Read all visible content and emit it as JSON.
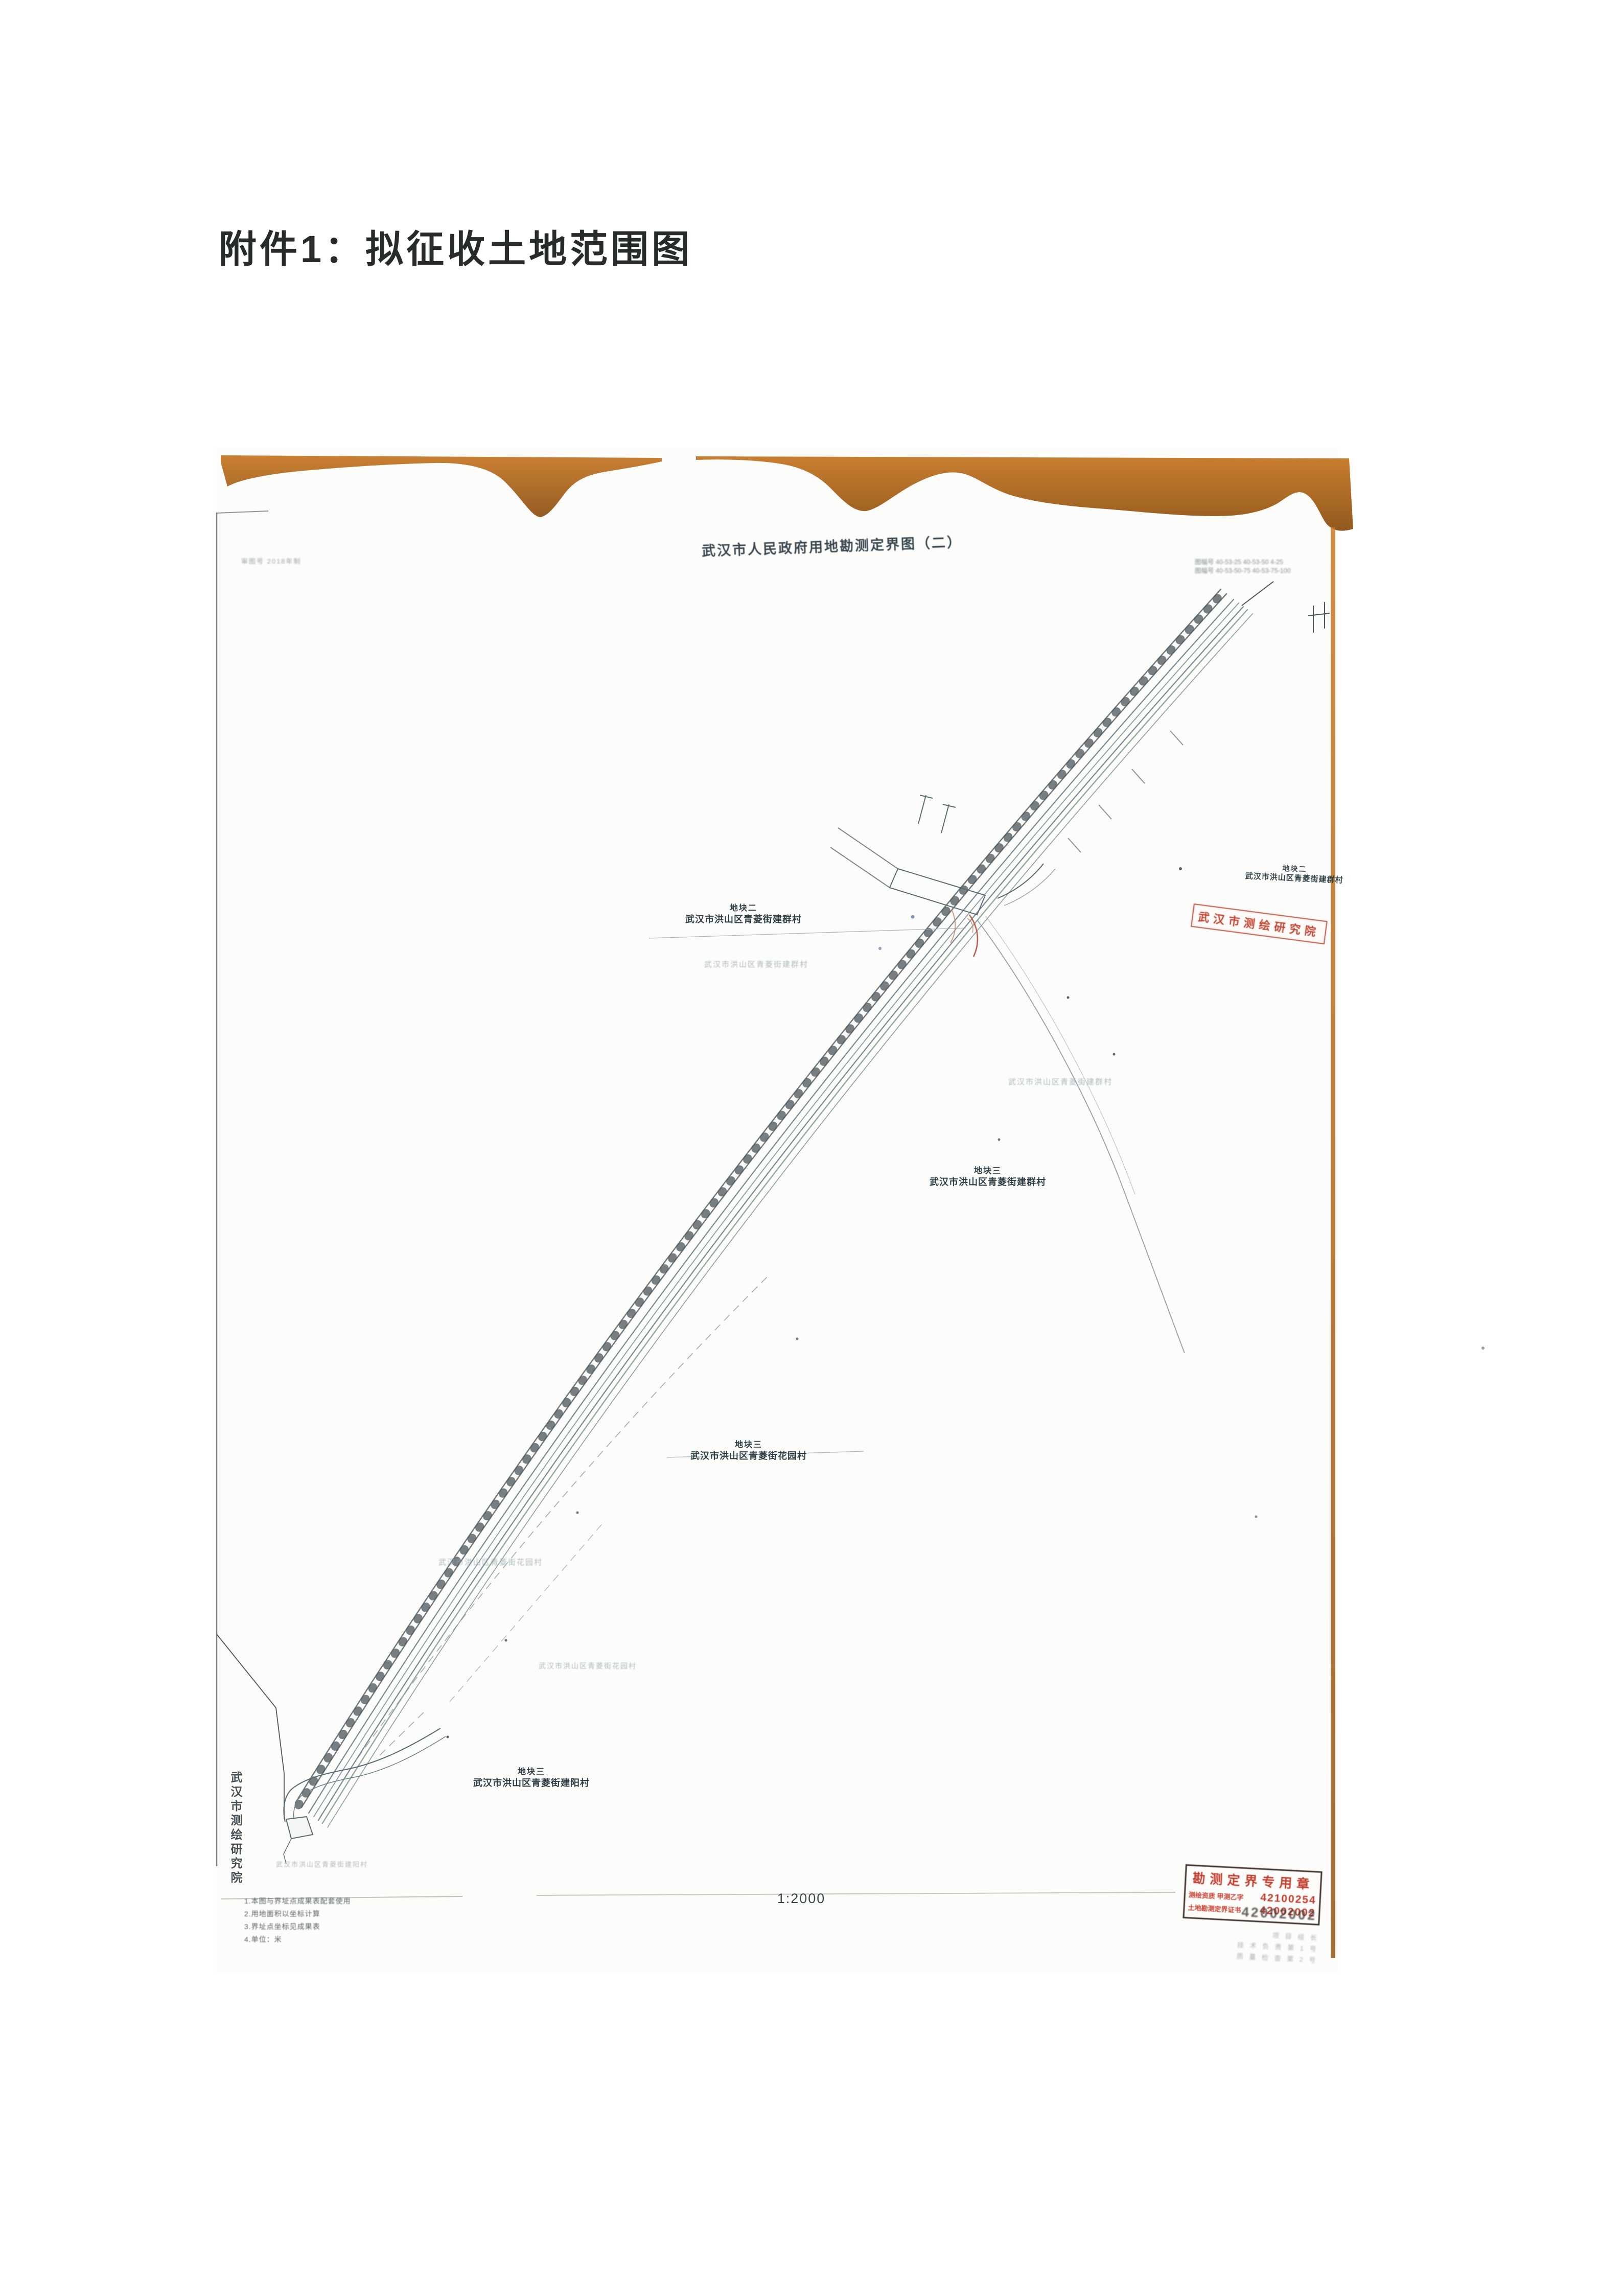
{
  "attachment": {
    "title": "附件1：拟征收土地范围图"
  },
  "map": {
    "title": "武汉市人民政府用地勘测定界图（二）",
    "scale_label": "1:2000",
    "top_left_note": "审图号 2018年制",
    "sheet_numbers": {
      "line1": "图幅号 40-53-25 40-53-50 4-25",
      "line2": "图幅号 40-53-50-75 40-53-75-100"
    },
    "plot_labels": [
      {
        "line1": "地块二",
        "line2": "武汉市洪山区青菱街建群村"
      },
      {
        "line1": "地块二",
        "line2": "武汉市洪山区青菱街建群村"
      },
      {
        "line1": "地块三",
        "line2": "武汉市洪山区青菱街建群村"
      },
      {
        "line1": "地块三",
        "line2": "武汉市洪山区青菱街花园村"
      },
      {
        "line1": "地块三",
        "line2": "武汉市洪山区青菱街建阳村"
      }
    ],
    "faint_labels": [
      "武汉市洪山区青菱街建群村",
      "武汉市洪山区青菱街建群村",
      "武汉市洪山区青菱街花园村",
      "武汉市洪山区青菱街花园村",
      "武汉市洪山区青菱街建阳村"
    ],
    "left_margin_vertical_text": "武汉市测绘研究院",
    "surveyor_stamp_text": "武汉市测绘研究院",
    "certification_stamp": {
      "title": "勘测定界专用章",
      "line2_label": "测绘资质 甲测乙字",
      "line2_number": "42100254",
      "line3_label": "土地勘测定界证书",
      "line3_number": "42002002",
      "overlap_number": "42002002",
      "sub_lines": [
        "项 目 组 长",
        "技 术 负 责  第 1 号",
        "质 量 检 查  第 2 号"
      ]
    },
    "notes": [
      "1.本图与界址点成果表配套使用",
      "2.用地面积以坐标计算",
      "3.界址点坐标见成果表",
      "4.单位：米"
    ]
  }
}
